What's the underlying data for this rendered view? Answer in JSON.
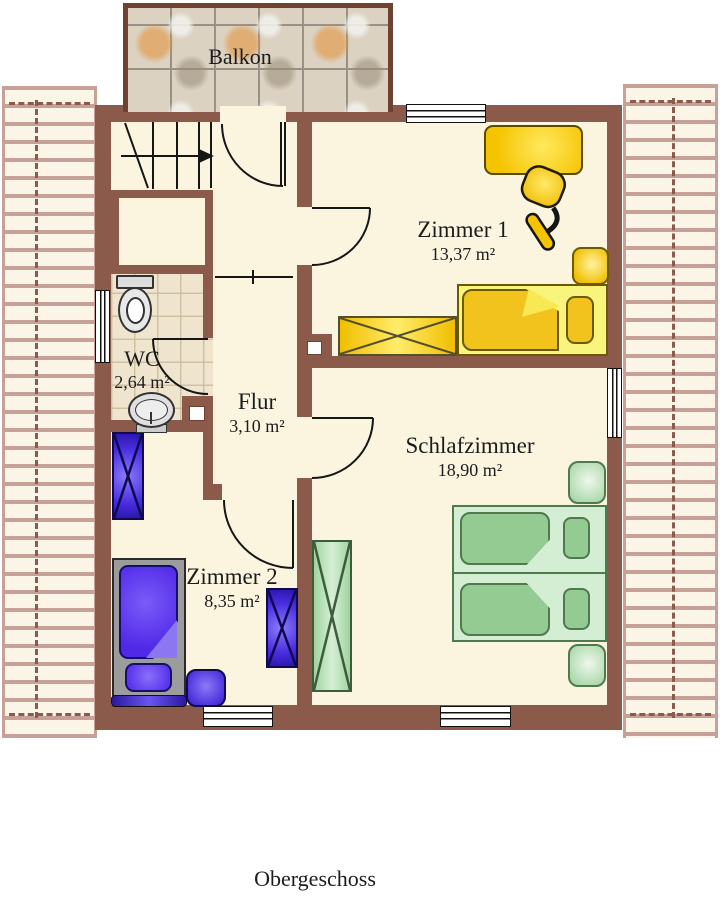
{
  "title": "Obergeschoss",
  "rooms": {
    "balkon": {
      "label": "Balkon"
    },
    "zimmer1": {
      "label": "Zimmer 1",
      "area": "13,37 m²"
    },
    "wc": {
      "label": "WC",
      "area": "2,64 m²"
    },
    "flur": {
      "label": "Flur",
      "area": "3,10 m²"
    },
    "schlafzimmer": {
      "label": "Schlafzimmer",
      "area": "18,90 m²"
    },
    "zimmer2": {
      "label": "Zimmer 2",
      "area": "8,35 m²"
    }
  },
  "colors": {
    "wall": "#8B5A4A",
    "balcony_border": "#6E4130",
    "floor": "#FBF4DF",
    "wc_tile": "#EFE5CF",
    "roof_stripe": "#C7A198",
    "furniture_yellow": "#F5C400",
    "furniture_green": "#93CB93",
    "furniture_blue": "#5028E8",
    "bed_frame_gray": "#9C9C9C"
  }
}
